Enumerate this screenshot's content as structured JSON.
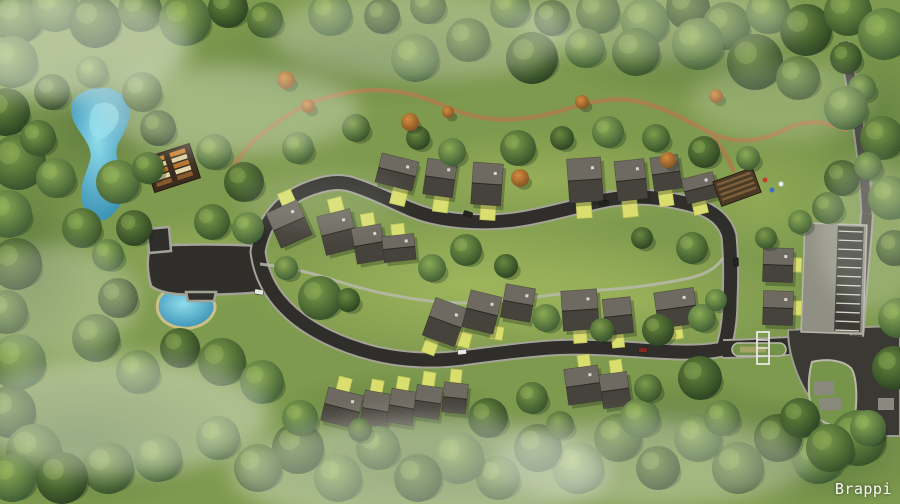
{
  "watermark": {
    "label": "Brappi"
  },
  "palette": {
    "grass_base": "#7e9a4e",
    "grass_light": "#b9cc68",
    "grass_dark": "#3d5a2e",
    "asphalt": "#2f2e2b",
    "asphalt_old": "#3a3934",
    "curb": "#a3a396",
    "street": "#4b4a45",
    "street_curb": "#96968a",
    "footpath": "#b9b9aa",
    "trail": "#a8804b",
    "roof_light": "#6e6a61",
    "roof_dark": "#46433c",
    "ridge": "#2b2925",
    "shadow": "#1a2415",
    "pad": "#dade6f",
    "pad_edge": "#c2c75c",
    "water_edge": "#cabf85",
    "parking_light": "#908f83",
    "parking_dark": "#3b3a35",
    "stripe": "#d3d3c6",
    "median_green": "#74914a",
    "gate_white": "#e9e9e2",
    "fog": "#eef2e6",
    "deck_brown": "#3a2d20",
    "pavilion_brown": "#4a3a26"
  },
  "scene": {
    "roads": {
      "loop": "M258 252 C262 224 281 200 306 190 C326 182 341 180 356 186 C386 196 406 210 431 216 C456 222 491 224 521 219 C551 214 576 206 606 200 C636 194 669 198 696 206 C713 211 725 221 729 236 C731 258 731 280 730 300 C730 320 727 338 723 349 C700 354 670 352 640 350 C610 348 580 346 550 348 C520 350 492 354 462 358 C432 362 400 360 372 353 C341 345 311 331 291 313 C272 296 261 276 258 252 Z",
      "stub": "M723 349 C745 349 765 347 789 346",
      "plaza": "M150 246 C186 244 224 244 262 246 L262 292 C240 294 214 295 196 294 C176 296 158 292 151 286 C147 272 147 258 150 246 Z",
      "plaza_knob": "M147 229 L169 227 L171 251 L149 253 Z",
      "plaza_step": "M186 292 L216 292 L214 301 L188 301 Z",
      "junction": "M788 330 C824 328 862 327 900 326 L900 436 L858 436 C836 430 812 408 799 378 C792 362 788 346 788 330 Z",
      "parcel": "M812 362 C828 358 844 361 851 368 C856 375 857 392 856 406 L854 425 C838 429 822 425 814 413 C808 402 807 380 812 362 Z",
      "street_top": "M843 42 C851 76 858 118 863 160 C865 180 866 198 867 214",
      "street_right": "M867 214 C865 244 862 274 860 300 C859 318 858 328 857 336",
      "footpath": "M260 264 C292 268 312 273 337 281 C362 289 392 296 422 300 C452 304 482 304 512 300 C542 296 572 292 602 290 C632 288 662 284 690 278 C706 274 717 268 723 258",
      "trail": "M252 142 C274 124 296 107 322 99 C348 91 372 88 400 92 C426 96 440 106 463 113 C491 122 520 121 548 114 C576 107 600 97 629 100 C661 104 686 121 711 133 C736 145 761 142 786 129 C806 119 826 121 846 130",
      "trail_spur1": "M252 142 C244 152 237 160 231 170",
      "trail_spur2": "M711 133 C720 145 728 158 733 170"
    },
    "water": {
      "lake": "M78 95 C95 83 116 86 126 99 C134 111 128 127 120 140 C112 154 119 164 125 177 C129 190 123 204 112 215 C101 226 88 219 83 205 C77 190 86 175 90 160 C94 146 79 134 73 120 C69 107 72 100 78 95 Z",
      "lake_streak": "M95 105 C105 100 115 103 118 112 C121 121 114 130 107 136 C100 142 92 138 90 129 C88 120 90 110 95 105 Z",
      "pond": "M158 301 C161 290 177 285 194 289 C211 293 219 303 213 314 C207 325 191 331 176 327 C161 323 155 312 158 301 Z"
    },
    "grass_patches": [
      [
        470,
        285,
        230,
        80,
        "l",
        0.55
      ],
      [
        540,
        180,
        180,
        50,
        "l",
        0.4
      ],
      [
        200,
        260,
        90,
        50,
        "l",
        0.35
      ],
      [
        640,
        300,
        160,
        60,
        "l",
        0.35
      ],
      [
        760,
        200,
        80,
        60,
        "l",
        0.3
      ],
      [
        90,
        130,
        90,
        80,
        "d",
        0.4
      ],
      [
        80,
        440,
        160,
        70,
        "d",
        0.5
      ],
      [
        450,
        460,
        240,
        60,
        "d",
        0.45
      ],
      [
        820,
        450,
        120,
        60,
        "d",
        0.5
      ],
      [
        880,
        120,
        70,
        90,
        "d",
        0.35
      ],
      [
        30,
        250,
        60,
        120,
        "d",
        0.4
      ],
      [
        350,
        60,
        200,
        50,
        "d",
        0.3
      ],
      [
        700,
        60,
        150,
        45,
        "d",
        0.3
      ],
      [
        390,
        410,
        120,
        40,
        "d",
        0.3
      ],
      [
        680,
        420,
        120,
        45,
        "d",
        0.35
      ]
    ],
    "houses": [
      [
        397,
        172,
        38,
        30,
        14
      ],
      [
        440,
        178,
        30,
        36,
        8
      ],
      [
        487,
        184,
        30,
        42,
        4
      ],
      [
        585,
        180,
        34,
        44,
        -4
      ],
      [
        631,
        180,
        30,
        40,
        -6
      ],
      [
        666,
        173,
        28,
        34,
        -8
      ],
      [
        700,
        188,
        32,
        26,
        -14
      ],
      [
        289,
        224,
        34,
        38,
        -24
      ],
      [
        338,
        232,
        34,
        40,
        -14
      ],
      [
        369,
        244,
        30,
        36,
        -10
      ],
      [
        399,
        248,
        32,
        26,
        -6
      ],
      [
        445,
        322,
        34,
        40,
        20
      ],
      [
        482,
        312,
        32,
        38,
        14
      ],
      [
        518,
        303,
        30,
        34,
        10
      ],
      [
        580,
        310,
        36,
        40,
        -4
      ],
      [
        618,
        316,
        28,
        36,
        -6
      ],
      [
        676,
        308,
        40,
        36,
        -8
      ],
      [
        342,
        408,
        36,
        34,
        14
      ],
      [
        376,
        410,
        28,
        36,
        10
      ],
      [
        402,
        407,
        26,
        34,
        10
      ],
      [
        428,
        402,
        26,
        32,
        8
      ],
      [
        455,
        398,
        24,
        30,
        6
      ],
      [
        583,
        385,
        34,
        36,
        -8
      ],
      [
        615,
        390,
        28,
        34,
        -8
      ],
      [
        778,
        265,
        30,
        34,
        2
      ],
      [
        778,
        308,
        30,
        34,
        2
      ]
    ],
    "pads": [
      [
        399,
        196,
        15,
        18,
        14
      ],
      [
        441,
        203,
        15,
        18,
        8
      ],
      [
        488,
        211,
        15,
        18,
        4
      ],
      [
        584,
        209,
        15,
        18,
        -4
      ],
      [
        630,
        208,
        15,
        18,
        -6
      ],
      [
        666,
        198,
        14,
        16,
        -8
      ],
      [
        700,
        207,
        14,
        14,
        -14
      ],
      [
        287,
        199,
        14,
        16,
        -24
      ],
      [
        336,
        206,
        14,
        16,
        -14
      ],
      [
        368,
        221,
        13,
        15,
        -10
      ],
      [
        398,
        231,
        13,
        14,
        -6
      ],
      [
        430,
        347,
        13,
        14,
        20
      ],
      [
        464,
        340,
        13,
        14,
        14
      ],
      [
        497,
        333,
        12,
        13,
        10
      ],
      [
        580,
        336,
        13,
        14,
        -4
      ],
      [
        618,
        341,
        12,
        13,
        -6
      ],
      [
        676,
        332,
        13,
        14,
        -8
      ],
      [
        344,
        385,
        13,
        15,
        14
      ],
      [
        377,
        387,
        12,
        14,
        10
      ],
      [
        403,
        384,
        12,
        14,
        10
      ],
      [
        429,
        379,
        12,
        14,
        8
      ],
      [
        456,
        376,
        11,
        13,
        6
      ],
      [
        584,
        362,
        12,
        14,
        -8
      ],
      [
        616,
        367,
        12,
        14,
        -8
      ],
      [
        797,
        265,
        9,
        14,
        2
      ],
      [
        797,
        308,
        9,
        14,
        2
      ]
    ],
    "gray_pads": [
      [
        824,
        388,
        20,
        14,
        -2
      ],
      [
        830,
        404,
        22,
        12,
        -2
      ],
      [
        886,
        404,
        16,
        12,
        0
      ]
    ],
    "parking": {
      "x": 803,
      "y": 224,
      "w": 62,
      "h": 109,
      "strip_x": 836,
      "strip_w": 26,
      "rows": 12,
      "rot": 2,
      "cx": 834,
      "cy": 278
    },
    "median": {
      "x": 732,
      "y": 343,
      "w": 54,
      "h": 13
    },
    "gate": {
      "x": 757,
      "y": 332,
      "w": 12,
      "h": 32
    },
    "clubhouse": {
      "x": 172,
      "y": 168,
      "w": 48,
      "h": 36,
      "rot": -18,
      "cell_colors": [
        "#c98334",
        "#ddcf9f",
        "#b5742c",
        "#e4d6a6",
        "#8a5a2a"
      ]
    },
    "pavilion": {
      "x": 737,
      "y": 187,
      "w": 42,
      "h": 26,
      "rot": -20,
      "stripe": "#7a5f3a"
    },
    "play_dots": [
      [
        765,
        180,
        "#cc3b2a"
      ],
      [
        772,
        190,
        "#3a6fc4"
      ],
      [
        781,
        184,
        "#e8e8e8"
      ]
    ],
    "cars": [
      [
        468,
        214,
        18,
        1
      ],
      [
        462,
        352,
        -6,
        0
      ],
      [
        259,
        292,
        10,
        0
      ],
      [
        604,
        203,
        -8,
        1
      ],
      [
        643,
        350,
        2,
        2
      ],
      [
        736,
        262,
        88,
        1
      ]
    ],
    "car_colors": [
      "#e9e9e3",
      "#23231f",
      "#7e2a1f"
    ],
    "trees": [
      [
        18,
        18,
        26,
        0
      ],
      [
        55,
        8,
        24,
        1
      ],
      [
        95,
        22,
        26,
        2
      ],
      [
        140,
        10,
        22,
        0
      ],
      [
        185,
        20,
        26,
        1
      ],
      [
        228,
        8,
        20,
        2
      ],
      [
        265,
        20,
        18,
        0
      ],
      [
        330,
        14,
        22,
        1
      ],
      [
        382,
        16,
        18,
        2
      ],
      [
        428,
        6,
        18,
        0
      ],
      [
        510,
        8,
        20,
        1
      ],
      [
        552,
        18,
        18,
        2
      ],
      [
        598,
        12,
        22,
        0
      ],
      [
        645,
        22,
        24,
        1
      ],
      [
        688,
        8,
        22,
        2
      ],
      [
        726,
        26,
        24,
        0
      ],
      [
        768,
        12,
        22,
        1
      ],
      [
        806,
        30,
        26,
        2
      ],
      [
        848,
        12,
        24,
        0
      ],
      [
        884,
        34,
        26,
        1
      ],
      [
        415,
        58,
        24,
        1
      ],
      [
        468,
        40,
        22,
        0
      ],
      [
        532,
        58,
        26,
        2
      ],
      [
        585,
        48,
        20,
        1
      ],
      [
        636,
        52,
        24,
        0
      ],
      [
        698,
        44,
        26,
        1
      ],
      [
        755,
        62,
        28,
        2
      ],
      [
        798,
        78,
        22,
        0
      ],
      [
        846,
        58,
        16,
        2
      ],
      [
        862,
        88,
        14,
        1
      ],
      [
        12,
        62,
        26,
        1
      ],
      [
        6,
        112,
        24,
        2
      ],
      [
        18,
        162,
        28,
        0
      ],
      [
        8,
        214,
        24,
        1
      ],
      [
        16,
        264,
        26,
        2
      ],
      [
        6,
        312,
        22,
        0
      ],
      [
        18,
        362,
        28,
        1
      ],
      [
        10,
        412,
        26,
        2
      ],
      [
        34,
        452,
        28,
        0
      ],
      [
        12,
        478,
        24,
        1
      ],
      [
        52,
        92,
        18,
        2
      ],
      [
        92,
        72,
        16,
        1
      ],
      [
        142,
        92,
        20,
        0
      ],
      [
        158,
        128,
        18,
        2
      ],
      [
        118,
        182,
        22,
        1
      ],
      [
        82,
        228,
        20,
        0
      ],
      [
        134,
        228,
        18,
        2
      ],
      [
        56,
        178,
        20,
        1
      ],
      [
        38,
        138,
        18,
        0
      ],
      [
        108,
        255,
        16,
        1
      ],
      [
        148,
        168,
        16,
        0
      ],
      [
        214,
        152,
        18,
        1
      ],
      [
        244,
        182,
        20,
        2
      ],
      [
        212,
        222,
        18,
        0
      ],
      [
        248,
        228,
        16,
        1
      ],
      [
        118,
        298,
        20,
        2
      ],
      [
        96,
        338,
        24,
        0
      ],
      [
        138,
        372,
        22,
        1
      ],
      [
        180,
        348,
        20,
        2
      ],
      [
        222,
        362,
        24,
        0
      ],
      [
        262,
        382,
        22,
        1
      ],
      [
        298,
        148,
        16,
        1
      ],
      [
        356,
        128,
        14,
        0
      ],
      [
        418,
        138,
        12,
        2
      ],
      [
        452,
        152,
        14,
        1
      ],
      [
        518,
        148,
        18,
        0
      ],
      [
        562,
        138,
        12,
        2
      ],
      [
        608,
        132,
        16,
        1
      ],
      [
        656,
        138,
        14,
        0
      ],
      [
        704,
        152,
        16,
        2
      ],
      [
        748,
        158,
        12,
        1
      ],
      [
        286,
        80,
        9,
        3
      ],
      [
        308,
        106,
        7,
        3
      ],
      [
        410,
        122,
        9,
        3
      ],
      [
        448,
        112,
        6,
        3
      ],
      [
        520,
        178,
        9,
        3
      ],
      [
        582,
        102,
        7,
        3
      ],
      [
        668,
        160,
        8,
        3
      ],
      [
        716,
        96,
        7,
        3
      ],
      [
        320,
        298,
        22,
        0
      ],
      [
        286,
        268,
        12,
        1
      ],
      [
        348,
        300,
        12,
        2
      ],
      [
        432,
        268,
        14,
        1
      ],
      [
        466,
        250,
        16,
        0
      ],
      [
        506,
        266,
        12,
        2
      ],
      [
        546,
        318,
        14,
        1
      ],
      [
        602,
        330,
        12,
        0
      ],
      [
        658,
        330,
        16,
        2
      ],
      [
        702,
        318,
        14,
        1
      ],
      [
        692,
        248,
        16,
        0
      ],
      [
        642,
        238,
        11,
        2
      ],
      [
        716,
        300,
        11,
        1
      ],
      [
        846,
        108,
        22,
        1
      ],
      [
        882,
        138,
        22,
        0
      ],
      [
        842,
        178,
        18,
        2
      ],
      [
        890,
        198,
        22,
        1
      ],
      [
        828,
        208,
        16,
        0
      ],
      [
        894,
        248,
        18,
        2
      ],
      [
        800,
        222,
        12,
        1
      ],
      [
        766,
        238,
        11,
        0
      ],
      [
        898,
        318,
        20,
        1
      ],
      [
        894,
        368,
        22,
        2
      ],
      [
        868,
        166,
        14,
        1
      ],
      [
        858,
        438,
        28,
        0
      ],
      [
        818,
        458,
        26,
        1
      ],
      [
        778,
        438,
        24,
        2
      ],
      [
        738,
        468,
        26,
        0
      ],
      [
        698,
        438,
        24,
        1
      ],
      [
        658,
        468,
        22,
        2
      ],
      [
        618,
        438,
        24,
        0
      ],
      [
        578,
        468,
        26,
        1
      ],
      [
        538,
        448,
        24,
        2
      ],
      [
        498,
        478,
        22,
        0
      ],
      [
        458,
        458,
        26,
        1
      ],
      [
        418,
        478,
        24,
        2
      ],
      [
        378,
        448,
        22,
        0
      ],
      [
        338,
        478,
        24,
        1
      ],
      [
        298,
        448,
        26,
        2
      ],
      [
        258,
        468,
        24,
        0
      ],
      [
        218,
        438,
        22,
        1
      ],
      [
        158,
        458,
        24,
        1
      ],
      [
        108,
        468,
        26,
        0
      ],
      [
        62,
        478,
        26,
        2
      ],
      [
        300,
        418,
        18,
        1
      ],
      [
        488,
        418,
        20,
        2
      ],
      [
        532,
        398,
        16,
        0
      ],
      [
        640,
        418,
        20,
        1
      ],
      [
        700,
        378,
        22,
        2
      ],
      [
        648,
        388,
        14,
        0
      ],
      [
        722,
        418,
        18,
        1
      ],
      [
        800,
        418,
        20,
        2
      ],
      [
        830,
        448,
        24,
        0
      ],
      [
        868,
        428,
        18,
        1
      ],
      [
        560,
        425,
        14,
        0
      ],
      [
        360,
        430,
        12,
        2
      ]
    ],
    "fog": [
      [
        60,
        45,
        130,
        55,
        0.5
      ],
      [
        230,
        110,
        130,
        45,
        0.33
      ],
      [
        420,
        35,
        150,
        45,
        0.3
      ],
      [
        660,
        22,
        140,
        38,
        0.28
      ],
      [
        120,
        415,
        150,
        60,
        0.42
      ],
      [
        50,
        300,
        90,
        55,
        0.3
      ],
      [
        420,
        472,
        190,
        55,
        0.4
      ],
      [
        650,
        462,
        160,
        45,
        0.33
      ],
      [
        872,
        235,
        55,
        75,
        0.22
      ],
      [
        320,
        200,
        80,
        30,
        0.12
      ],
      [
        780,
        100,
        90,
        40,
        0.2
      ]
    ]
  }
}
